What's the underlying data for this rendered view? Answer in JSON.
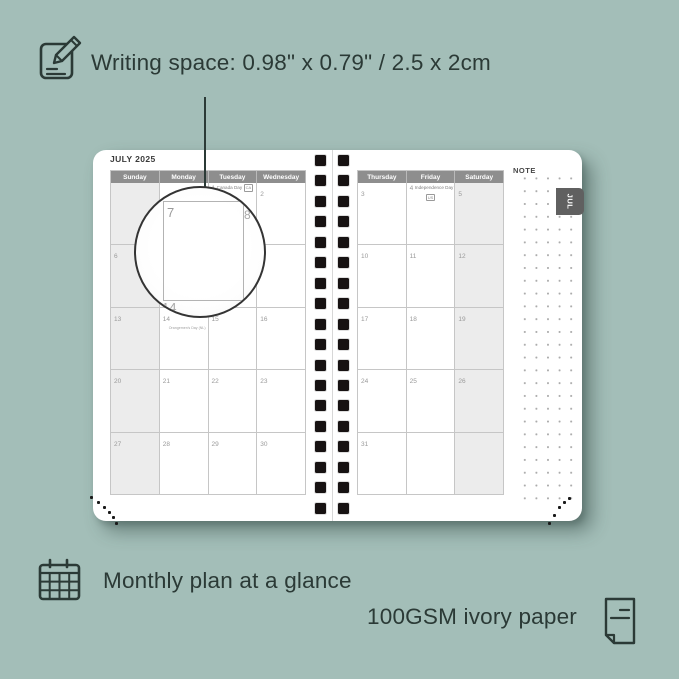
{
  "colors": {
    "background": "#a3beb8",
    "ink": "#2b3a36",
    "page": "#ffffff",
    "header_bg": "#8e8e8e",
    "weekend_bg": "#ececec",
    "grid_line": "#c6c6c6",
    "date_number": "#9a9a9a",
    "tab_bg": "#606060"
  },
  "captions": {
    "writing_space": "Writing space: 0.98\" x 0.79\" / 2.5 x 2cm",
    "monthly_plan": "Monthly plan at a glance",
    "paper": "100GSM ivory paper"
  },
  "planner": {
    "month_title": "JULY 2025",
    "tab_label": "JUL",
    "note_label": "NOTE",
    "left_page": {
      "day_headers": [
        "Sunday",
        "Monday",
        "Tuesday",
        "Wednesday"
      ],
      "weekend_col": 0,
      "rows": [
        [
          {
            "d": ""
          },
          {
            "d": ""
          },
          {
            "d": "1",
            "holiday": "Canada Day",
            "tag": "CA",
            "layout": "inline"
          },
          {
            "d": "2"
          }
        ],
        [
          {
            "d": "6"
          },
          {
            "d": "7"
          },
          {
            "d": "8"
          },
          {
            "d": "9"
          }
        ],
        [
          {
            "d": "13"
          },
          {
            "d": "14",
            "holiday": "Orangemen's Day (NL)",
            "layout": "name-below"
          },
          {
            "d": "15"
          },
          {
            "d": "16"
          }
        ],
        [
          {
            "d": "20"
          },
          {
            "d": "21"
          },
          {
            "d": "22"
          },
          {
            "d": "23"
          }
        ],
        [
          {
            "d": "27"
          },
          {
            "d": "28"
          },
          {
            "d": "29"
          },
          {
            "d": "30"
          }
        ]
      ]
    },
    "right_page": {
      "day_headers": [
        "Thursday",
        "Friday",
        "Saturday"
      ],
      "weekend_col": 2,
      "rows": [
        [
          {
            "d": "3"
          },
          {
            "d": "4",
            "holiday": "Independence Day",
            "tag": "US",
            "layout": "tag-below"
          },
          {
            "d": "5"
          }
        ],
        [
          {
            "d": "10"
          },
          {
            "d": "11"
          },
          {
            "d": "12"
          }
        ],
        [
          {
            "d": "17"
          },
          {
            "d": "18"
          },
          {
            "d": "19"
          }
        ],
        [
          {
            "d": "24"
          },
          {
            "d": "25"
          },
          {
            "d": "26"
          }
        ],
        [
          {
            "d": "31"
          },
          {
            "d": ""
          },
          {
            "d": ""
          }
        ]
      ]
    },
    "magnifier": {
      "day": "7",
      "edge_top_right": "8",
      "edge_bottom": "14"
    }
  }
}
